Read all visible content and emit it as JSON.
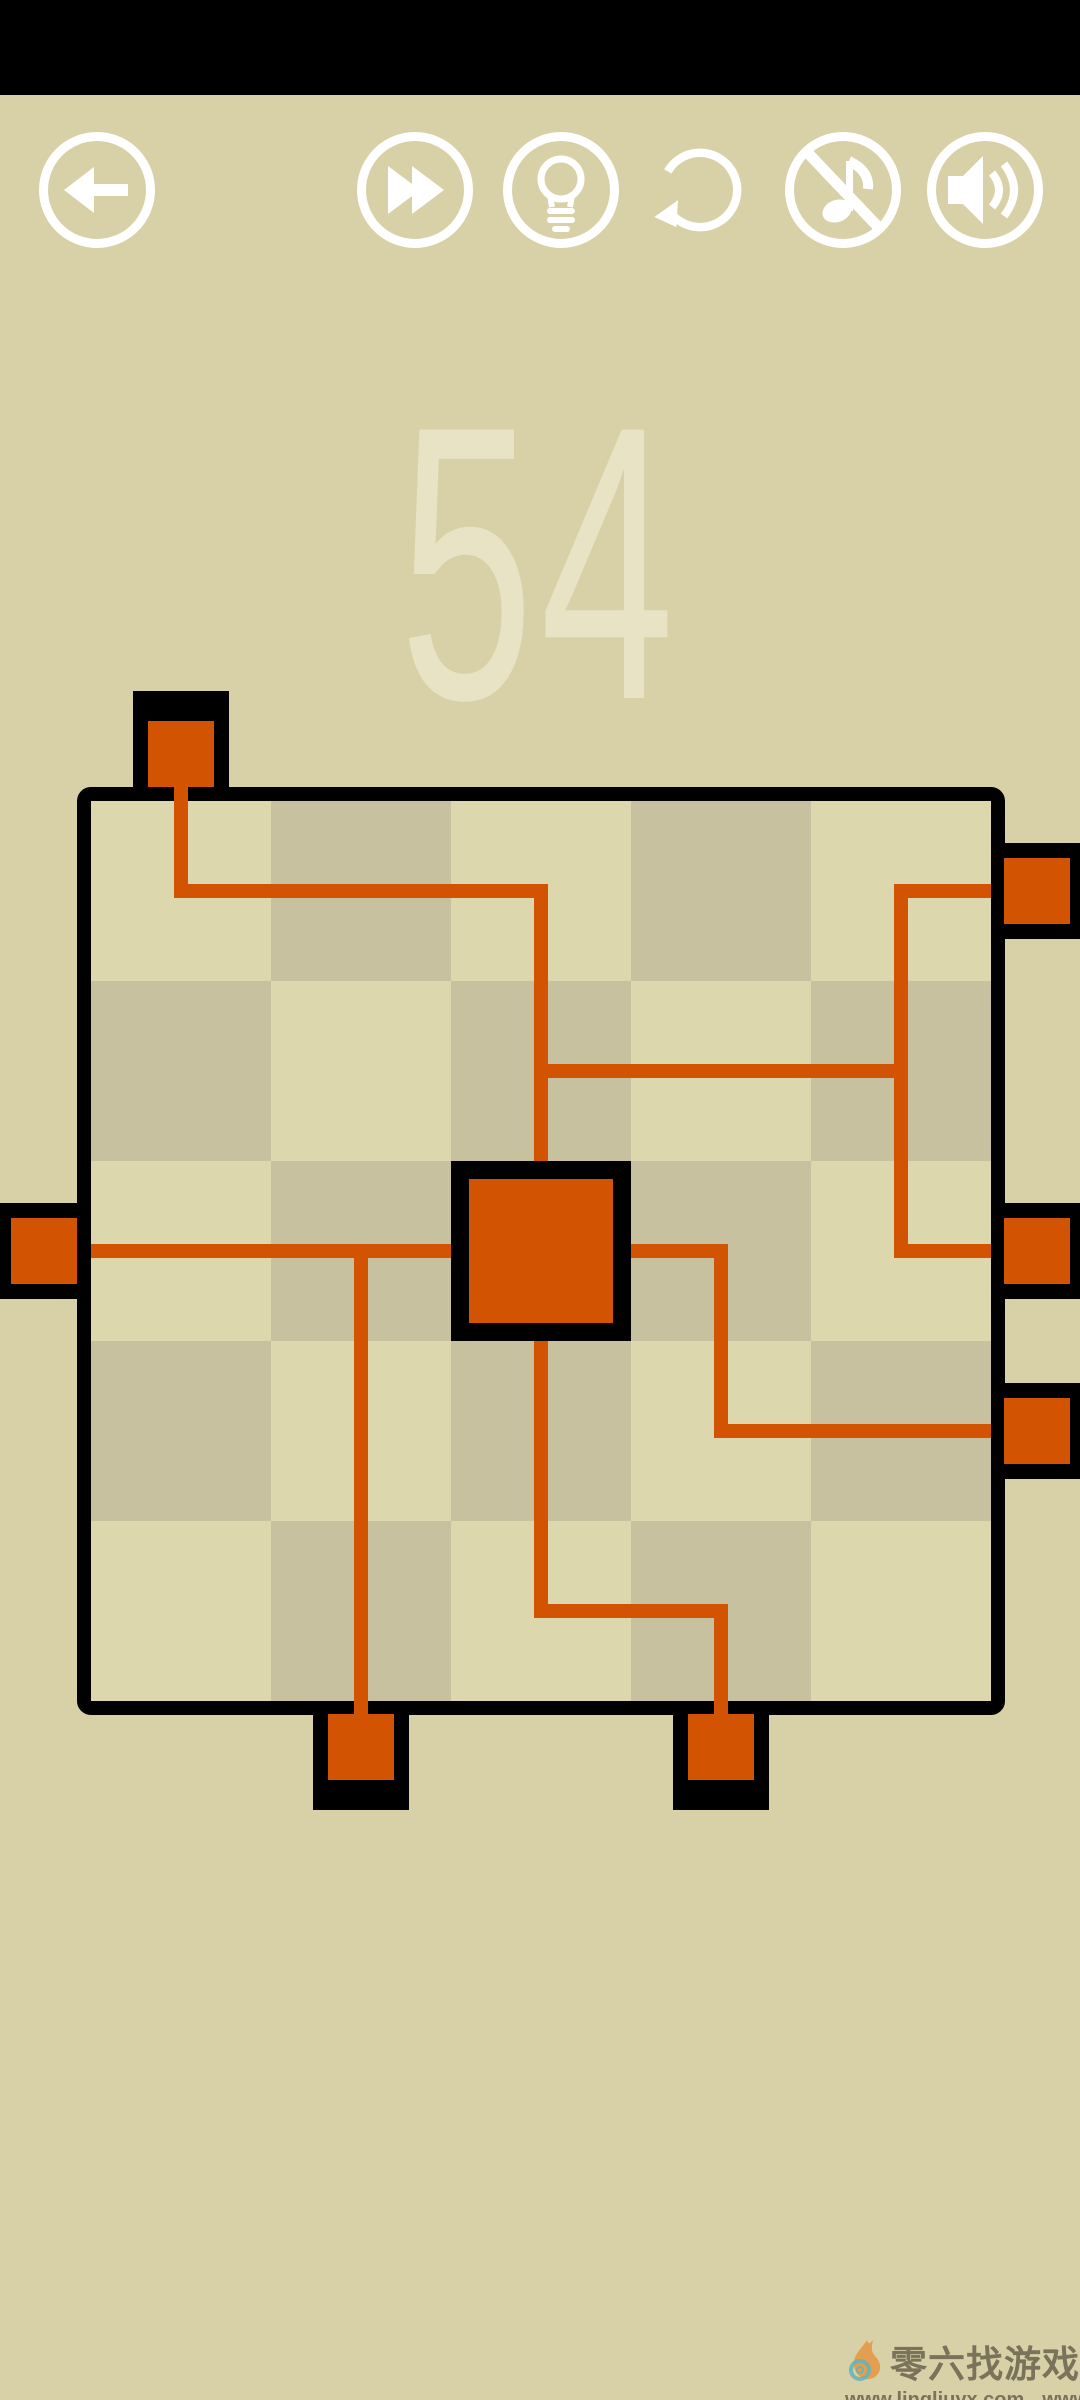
{
  "app": {
    "type": "pipe-puzzle-game"
  },
  "colors": {
    "background": "#d8d1a7",
    "statusbar": "#000000",
    "icon_white": "#ffffff",
    "cell_light": "#ddd7ae",
    "cell_dark": "#c8c1a0",
    "pipe_orange": "#d25402",
    "board_border": "#000000",
    "level_text": "#e9e3c5",
    "watermark_text": "#6a624e"
  },
  "toolbar": {
    "buttons": [
      {
        "id": "back",
        "icon": "arrow-left-icon"
      },
      {
        "id": "skip",
        "icon": "fast-forward-icon"
      },
      {
        "id": "hint",
        "icon": "lightbulb-icon"
      },
      {
        "id": "undo",
        "icon": "undo-arrow-icon"
      },
      {
        "id": "music-off",
        "icon": "music-note-off-icon"
      },
      {
        "id": "sound-on",
        "icon": "speaker-icon"
      }
    ]
  },
  "level": {
    "number": "54"
  },
  "board": {
    "grid": {
      "cols": 5,
      "rows": 5,
      "cell_px": 180,
      "origin_px": [
        91,
        801
      ]
    },
    "dark_cells": [
      [
        1,
        0
      ],
      [
        3,
        0
      ],
      [
        0,
        1
      ],
      [
        2,
        1
      ],
      [
        4,
        1
      ],
      [
        1,
        2
      ],
      [
        3,
        2
      ],
      [
        0,
        3
      ],
      [
        2,
        3
      ],
      [
        4,
        3
      ],
      [
        1,
        4
      ],
      [
        3,
        4
      ]
    ],
    "center_block": {
      "cell": [
        2,
        2
      ],
      "frame_rect": [
        451,
        1161,
        180,
        180
      ],
      "core_rect": [
        469,
        1179,
        144,
        144
      ]
    },
    "connectors": [
      {
        "edge": "top",
        "at_col": 0,
        "frame_rect": [
          133,
          691,
          96,
          96
        ],
        "core_rect": [
          148,
          721,
          66,
          66
        ]
      },
      {
        "edge": "left",
        "at_row": 2,
        "frame_rect": [
          -19,
          1203,
          96,
          96
        ],
        "core_rect": [
          11,
          1218,
          66,
          66
        ]
      },
      {
        "edge": "right",
        "at_row": 0,
        "frame_rect": [
          1004,
          843,
          96,
          96
        ],
        "core_rect": [
          1004,
          858,
          66,
          66
        ]
      },
      {
        "edge": "right",
        "at_row": 2,
        "frame_rect": [
          1004,
          1203,
          96,
          96
        ],
        "core_rect": [
          1004,
          1218,
          66,
          66
        ]
      },
      {
        "edge": "right",
        "at_row": 3,
        "frame_rect": [
          1004,
          1383,
          96,
          96
        ],
        "core_rect": [
          1004,
          1398,
          66,
          66
        ]
      },
      {
        "edge": "bottom",
        "at_col": 1,
        "frame_rect": [
          313,
          1714,
          96,
          96
        ],
        "core_rect": [
          328,
          1714,
          66,
          66
        ]
      },
      {
        "edge": "bottom",
        "at_col": 3,
        "frame_rect": [
          673,
          1714,
          96,
          96
        ],
        "core_rect": [
          688,
          1714,
          66,
          66
        ]
      }
    ],
    "pipe_rects": [
      [
        174,
        787,
        14,
        111
      ],
      [
        174,
        884,
        374,
        14
      ],
      [
        534,
        884,
        14,
        277
      ],
      [
        534,
        1064,
        374,
        14
      ],
      [
        894,
        884,
        14,
        374
      ],
      [
        894,
        884,
        97,
        14
      ],
      [
        894,
        1244,
        97,
        14
      ],
      [
        91,
        1244,
        360,
        14
      ],
      [
        354,
        1244,
        14,
        470
      ],
      [
        631,
        1244,
        97,
        14
      ],
      [
        714,
        1244,
        14,
        194
      ],
      [
        714,
        1424,
        277,
        14
      ],
      [
        534,
        1341,
        14,
        277
      ],
      [
        534,
        1604,
        194,
        14
      ],
      [
        714,
        1604,
        14,
        110
      ]
    ]
  },
  "watermark": {
    "brand": "零六找游戏",
    "url1": "www.lingliuyx.com",
    "url2": "www.06zyx.com"
  }
}
